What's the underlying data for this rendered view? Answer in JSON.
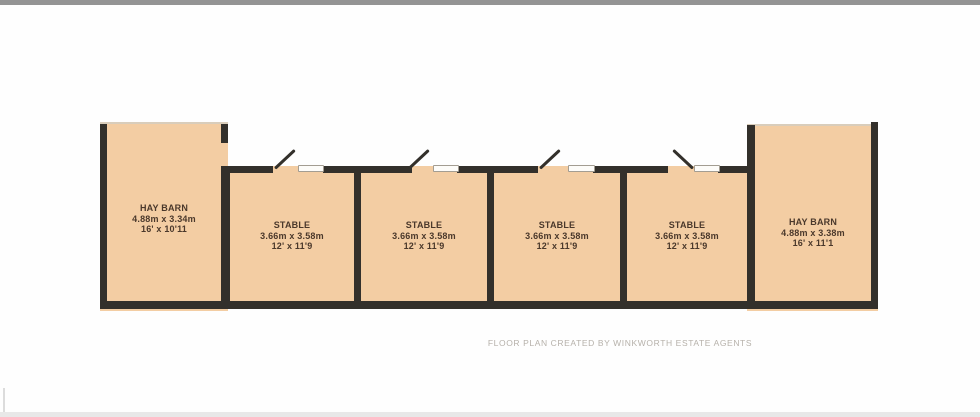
{
  "page": {
    "caption": "FLOOR PLAN CREATED BY WINKWORTH ESTATE AGENTS"
  },
  "rooms": [
    {
      "id": "hay-barn-left",
      "name": "HAY BARN",
      "metric": "4.88m x 3.34m",
      "imperial": "16' x 10'11"
    },
    {
      "id": "stable-1",
      "name": "STABLE",
      "metric": "3.66m x 3.58m",
      "imperial": "12' x 11'9"
    },
    {
      "id": "stable-2",
      "name": "STABLE",
      "metric": "3.66m x 3.58m",
      "imperial": "12' x 11'9"
    },
    {
      "id": "stable-3",
      "name": "STABLE",
      "metric": "3.66m x 3.58m",
      "imperial": "12' x 11'9"
    },
    {
      "id": "stable-4",
      "name": "STABLE",
      "metric": "3.66m x 3.58m",
      "imperial": "12' x 11'9"
    },
    {
      "id": "hay-barn-right",
      "name": "HAY BARN",
      "metric": "4.88m x 3.38m",
      "imperial": "16' x 11'1"
    }
  ],
  "colors": {
    "room_fill": "#f3cda3",
    "wall": "#33302b",
    "label_text": "#4a382b",
    "caption_text": "#b6b1aa"
  }
}
